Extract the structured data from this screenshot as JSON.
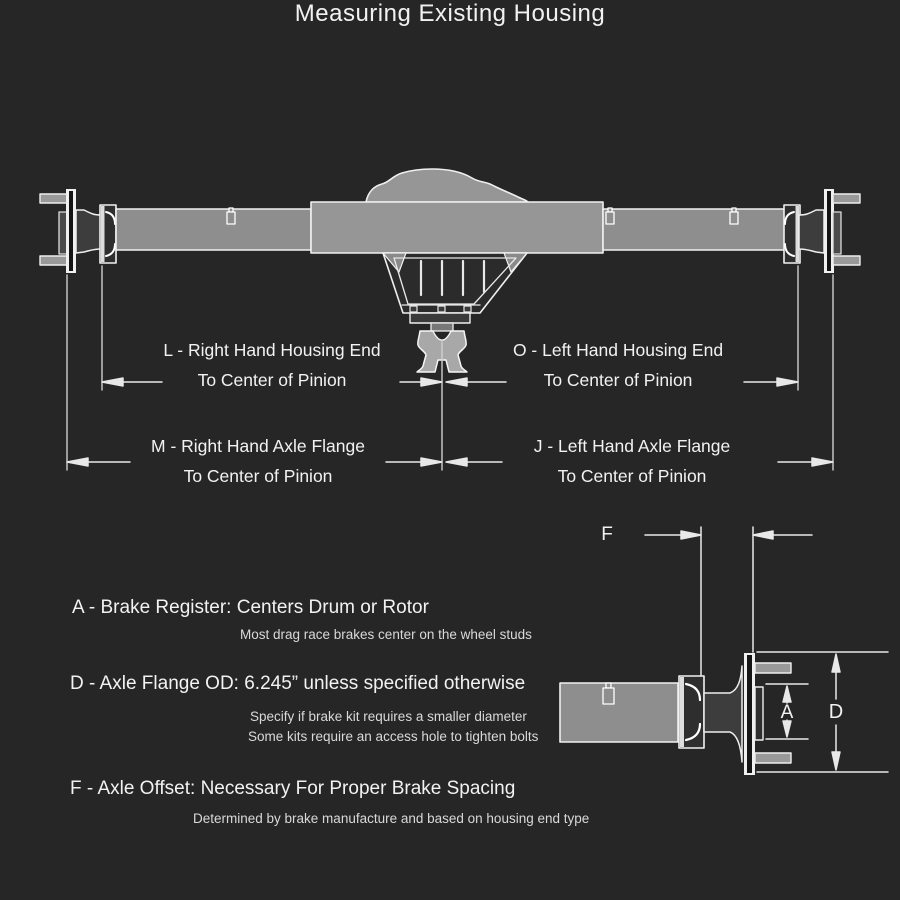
{
  "title": "Measuring Existing Housing",
  "colors": {
    "background": "#262626",
    "metal_gray": "#8e8e8e",
    "outline_white": "#f2f2f2",
    "dimension_line": "#d9d9d9",
    "note_text": "#d9d9d9"
  },
  "main_diagram": {
    "L": {
      "line1": "L - Right Hand Housing End",
      "line2": "To Center of Pinion"
    },
    "O": {
      "line1": "O - Left Hand Housing End",
      "line2": "To Center of Pinion"
    },
    "M": {
      "line1": "M - Right Hand Axle Flange",
      "line2": "To Center of Pinion"
    },
    "J": {
      "line1": "J - Left Hand Axle Flange",
      "line2": "To Center of Pinion"
    }
  },
  "detail_labels": {
    "f": "F",
    "a": "A",
    "d": "D"
  },
  "legend": {
    "a_heading": "A - Brake Register: Centers Drum or Rotor",
    "a_note": "Most drag race brakes center on the wheel studs",
    "d_heading": "D - Axle Flange OD: 6.245” unless specified otherwise",
    "d_note1": "Specify if brake kit requires a smaller diameter",
    "d_note2": "Some kits require an access hole to tighten bolts",
    "f_heading": "F - Axle Offset: Necessary For Proper Brake Spacing",
    "f_note": "Determined by brake manufacture and based on housing end type"
  }
}
